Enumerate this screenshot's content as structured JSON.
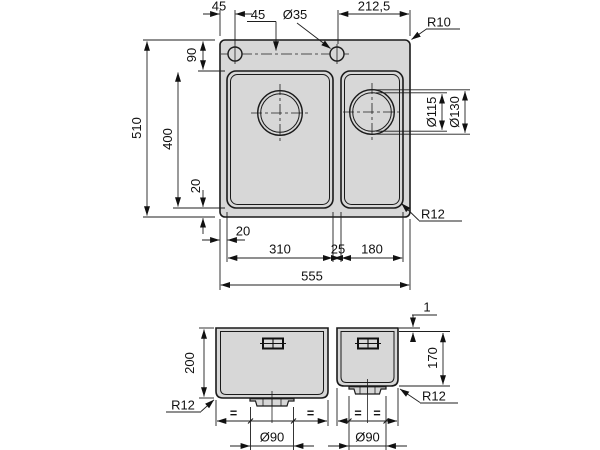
{
  "colors": {
    "line": "#1a1a1a",
    "fill_gray": "#d7d7d7",
    "background": "#ffffff"
  },
  "top_view": {
    "dims": {
      "hole_offset_left": "45",
      "hole_depth": "45",
      "hole_diameter": "Ø35",
      "hole_offset_right": "212,5",
      "outer_corner_radius": "R10",
      "rim_top": "90",
      "overall_depth": "510",
      "bowl_depth": "400",
      "rim_bottom": "20",
      "drain_inner_dia": "Ø115",
      "drain_outer_dia": "Ø130",
      "bowl_corner_radius": "R12",
      "rim_left": "20",
      "left_bowl_width": "310",
      "bowl_gap": "25",
      "right_bowl_width": "180",
      "overall_width": "555"
    }
  },
  "front_view": {
    "dims": {
      "rim_thickness": "1",
      "left_bowl_height": "200",
      "right_bowl_height": "170",
      "corner_radius_left": "R12",
      "corner_radius_right": "R12",
      "drain_left_dia": "Ø90",
      "drain_right_dia": "Ø90",
      "equal_mark": "="
    }
  }
}
